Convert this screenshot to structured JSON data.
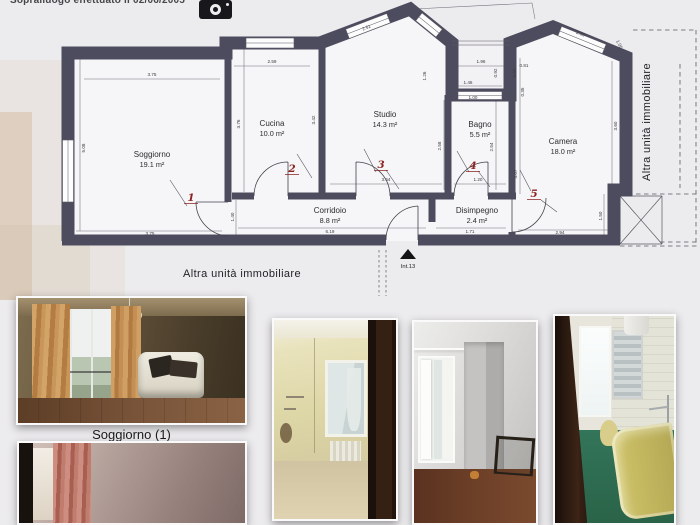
{
  "header": {
    "note": "Sopralluogo effettuato il 02/06/2005",
    "camera_icon": "camera-icon"
  },
  "plan": {
    "rooms": [
      {
        "name": "Soggiorno",
        "area": "19.1 m²",
        "number": "1"
      },
      {
        "name": "Cucina",
        "area": "10.0 m²",
        "number": "2"
      },
      {
        "name": "Studio",
        "area": "14.3 m²",
        "number": "3"
      },
      {
        "name": "Bagno",
        "area": "5.5 m²",
        "number": "4"
      },
      {
        "name": "Camera",
        "area": "18.0 m²",
        "number": "5"
      },
      {
        "name": "Corridoio",
        "area": "8.8 m²"
      },
      {
        "name": "Disimpegno",
        "area": "2.4 m²"
      }
    ],
    "annotations": {
      "other_unit_right": "Altra unità immobiliare",
      "other_unit_bottom": "Altra unità immobiliare",
      "entrance_label": "Int.13"
    },
    "dims": [
      "3.75",
      "2.59",
      "2.51",
      "1.96",
      "0.81",
      "2.35",
      "1.05",
      "5.08",
      "3.76",
      "3.42",
      "2.58",
      "2.54",
      "4.07",
      "3.60",
      "1.50",
      "2.94",
      "1.71",
      "6.19",
      "3.75",
      "1.40",
      "3.64",
      "1.20",
      "1.46",
      "1.00",
      "0.92",
      "0.92",
      "0.35",
      "1.26"
    ],
    "colors": {
      "wall": "#4d4c5e",
      "floor": "#f6f5f7",
      "room_number": "#8b2323",
      "dim_text": "#3b3b40"
    }
  },
  "photos": {
    "caption_soggiorno": "Soggiorno (1)"
  }
}
